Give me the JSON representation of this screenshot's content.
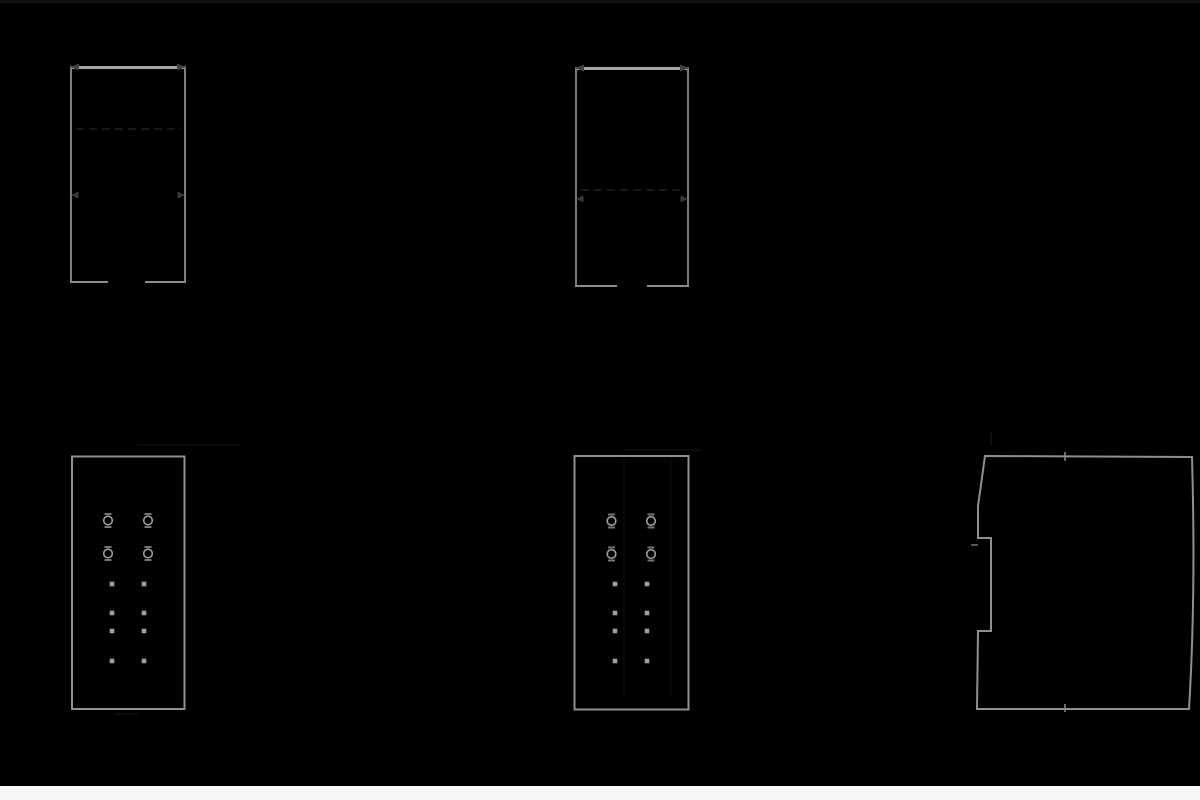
{
  "document": {
    "kind": "technical-dimension-drawing",
    "style": "inverted-dark",
    "background_color": "#000000",
    "page_strip_color": "#f8f8f8"
  },
  "colors": {
    "outline": "#8f8f8f",
    "outline_bright": "#a6a6a6",
    "outline_dim": "#787878",
    "terminal": "#9e9e9e",
    "bracket": "#757575",
    "led": "#9e9e9e",
    "arrow": "#3c3c3c",
    "faint": "#1c1c1c",
    "very_faint": "#111111"
  },
  "primitives": [
    {
      "name": "top-edge-band",
      "kind": "band",
      "x": 0,
      "y": 0,
      "width": 1200,
      "height": 3,
      "fill": "#121212"
    },
    {
      "name": "bottom-page-band",
      "kind": "band",
      "x": 0,
      "y": 786,
      "width": 1200,
      "height": 14,
      "fill": "#f8f8f8"
    },
    {
      "name": "front-view-1-top-edge",
      "kind": "line",
      "x1": 70,
      "y1": 67.5,
      "x2": 186,
      "y2": 67.5,
      "stroke": "#a6a6a6",
      "w": 3
    },
    {
      "name": "front-view-1-left-edge",
      "kind": "line",
      "x1": 71,
      "y1": 66,
      "x2": 71,
      "y2": 283,
      "stroke": "#7d7d7d",
      "w": 2
    },
    {
      "name": "front-view-1-right-edge",
      "kind": "line",
      "x1": 185,
      "y1": 66,
      "x2": 185,
      "y2": 283,
      "stroke": "#7d7d7d",
      "w": 2
    },
    {
      "name": "front-view-1-bottom-left-seg",
      "kind": "line",
      "x1": 70,
      "y1": 282,
      "x2": 108,
      "y2": 282,
      "stroke": "#8c8c8c",
      "w": 2
    },
    {
      "name": "front-view-1-bottom-right-seg",
      "kind": "line",
      "x1": 145,
      "y1": 282,
      "x2": 186,
      "y2": 282,
      "stroke": "#8c8c8c",
      "w": 2
    },
    {
      "name": "front-view-1-hidden-line",
      "kind": "line",
      "x1": 76,
      "y1": 129,
      "x2": 181,
      "y2": 129,
      "stroke": "#1f1f1f",
      "w": 1.5,
      "dash": "8 5"
    },
    {
      "name": "dim-arrow-icon",
      "kind": "path",
      "d": "M70,67 L79,63.5 L79,70.5 Z",
      "fill": "#404040"
    },
    {
      "name": "dim-arrow-icon",
      "kind": "path",
      "d": "M186,67 L177,63.5 L177,70.5 Z",
      "fill": "#404040"
    },
    {
      "name": "dim-arrow-icon",
      "kind": "path",
      "d": "M71,195 L78.5,191.5 L78.5,198.5 Z",
      "fill": "#383838"
    },
    {
      "name": "dim-arrow-icon",
      "kind": "path",
      "d": "M185,195 L177.5,191.5 L177.5,198.5 Z",
      "fill": "#383838"
    },
    {
      "name": "front-view-2-top-edge",
      "kind": "line",
      "x1": 575,
      "y1": 68.5,
      "x2": 689,
      "y2": 68.5,
      "stroke": "#a6a6a6",
      "w": 3
    },
    {
      "name": "front-view-2-left-edge",
      "kind": "line",
      "x1": 576,
      "y1": 67,
      "x2": 576,
      "y2": 287,
      "stroke": "#787878",
      "w": 2
    },
    {
      "name": "front-view-2-right-edge",
      "kind": "line",
      "x1": 688,
      "y1": 67,
      "x2": 688,
      "y2": 287,
      "stroke": "#787878",
      "w": 2
    },
    {
      "name": "front-view-2-bottom-left-seg",
      "kind": "line",
      "x1": 575,
      "y1": 286,
      "x2": 617,
      "y2": 286,
      "stroke": "#8c8c8c",
      "w": 2
    },
    {
      "name": "front-view-2-bottom-right-seg",
      "kind": "line",
      "x1": 647,
      "y1": 286,
      "x2": 689,
      "y2": 286,
      "stroke": "#8c8c8c",
      "w": 2
    },
    {
      "name": "front-view-2-hidden-line",
      "kind": "line",
      "x1": 581,
      "y1": 190,
      "x2": 683,
      "y2": 190,
      "stroke": "#202020",
      "w": 1.5,
      "dash": "8 5"
    },
    {
      "name": "dim-arrow-icon",
      "kind": "path",
      "d": "M575,68 L584,64.5 L584,71.5 Z",
      "fill": "#404040"
    },
    {
      "name": "dim-arrow-icon",
      "kind": "path",
      "d": "M689,68 L680,64.5 L680,71.5 Z",
      "fill": "#404040"
    },
    {
      "name": "dim-arrow-icon",
      "kind": "path",
      "d": "M576,199 L583.5,195.5 L583.5,202.5 Z",
      "fill": "#383838"
    },
    {
      "name": "dim-arrow-icon",
      "kind": "path",
      "d": "M688,199 L680.5,195.5 L680.5,202.5 Z",
      "fill": "#383838"
    },
    {
      "name": "terminal-view-1-outline",
      "kind": "rect",
      "x": 72,
      "y": 456.5,
      "width": 112.5,
      "height": 252.5,
      "stroke": "#909090",
      "w": 2
    },
    {
      "name": "terminal-view-1-dim-line-above",
      "kind": "line",
      "x1": 137,
      "y1": 445,
      "x2": 240,
      "y2": 445,
      "stroke": "#181818",
      "w": 1
    },
    {
      "name": "terminal-view-1-dim-line-below",
      "kind": "line",
      "x1": 116,
      "y1": 714,
      "x2": 138,
      "y2": 714,
      "stroke": "#181818",
      "w": 1
    },
    {
      "name": "screw-terminal-icon",
      "kind": "terminal",
      "cx": 108,
      "cy": 520.5
    },
    {
      "name": "screw-terminal-icon",
      "kind": "terminal",
      "cx": 148,
      "cy": 520.5
    },
    {
      "name": "screw-terminal-icon",
      "kind": "terminal",
      "cx": 108,
      "cy": 553.5
    },
    {
      "name": "screw-terminal-icon",
      "kind": "terminal",
      "cx": 148,
      "cy": 553.5
    },
    {
      "name": "led-indicator-icon",
      "kind": "sq",
      "cx": 112,
      "cy": 584,
      "s": 4.6
    },
    {
      "name": "led-indicator-icon",
      "kind": "sq",
      "cx": 144,
      "cy": 584,
      "s": 4.6
    },
    {
      "name": "led-indicator-icon",
      "kind": "sq",
      "cx": 112,
      "cy": 613,
      "s": 4.6
    },
    {
      "name": "led-indicator-icon",
      "kind": "sq",
      "cx": 144,
      "cy": 613,
      "s": 4.6
    },
    {
      "name": "led-indicator-icon",
      "kind": "sq",
      "cx": 112,
      "cy": 631,
      "s": 4.6
    },
    {
      "name": "led-indicator-icon",
      "kind": "sq",
      "cx": 144,
      "cy": 631,
      "s": 4.6
    },
    {
      "name": "led-indicator-icon",
      "kind": "sq",
      "cx": 112,
      "cy": 661,
      "s": 4.6
    },
    {
      "name": "led-indicator-icon",
      "kind": "sq",
      "cx": 144,
      "cy": 661,
      "s": 4.6
    },
    {
      "name": "terminal-view-2-outline",
      "kind": "rect",
      "x": 574.5,
      "y": 456,
      "width": 114,
      "height": 253.5,
      "stroke": "#909090",
      "w": 2
    },
    {
      "name": "terminal-view-2-seam-left",
      "kind": "line",
      "x1": 624,
      "y1": 458,
      "x2": 624,
      "y2": 698,
      "stroke": "#111111",
      "w": 1
    },
    {
      "name": "terminal-view-2-seam-right",
      "kind": "line",
      "x1": 671,
      "y1": 458,
      "x2": 671,
      "y2": 698,
      "stroke": "#111111",
      "w": 1
    },
    {
      "name": "terminal-view-2-dim-line-above",
      "kind": "line",
      "x1": 623,
      "y1": 450,
      "x2": 700,
      "y2": 450,
      "stroke": "#161616",
      "w": 1
    },
    {
      "name": "screw-terminal-icon",
      "kind": "terminal",
      "cx": 611.5,
      "cy": 521
    },
    {
      "name": "screw-terminal-icon",
      "kind": "terminal",
      "cx": 651,
      "cy": 521
    },
    {
      "name": "screw-terminal-icon",
      "kind": "terminal",
      "cx": 611.5,
      "cy": 554
    },
    {
      "name": "screw-terminal-icon",
      "kind": "terminal",
      "cx": 651,
      "cy": 554
    },
    {
      "name": "led-indicator-icon",
      "kind": "sq",
      "cx": 615,
      "cy": 584,
      "s": 4.6
    },
    {
      "name": "led-indicator-icon",
      "kind": "sq",
      "cx": 647,
      "cy": 584,
      "s": 4.6
    },
    {
      "name": "led-indicator-icon",
      "kind": "sq",
      "cx": 615,
      "cy": 613,
      "s": 4.6
    },
    {
      "name": "led-indicator-icon",
      "kind": "sq",
      "cx": 647,
      "cy": 613,
      "s": 4.6
    },
    {
      "name": "led-indicator-icon",
      "kind": "sq",
      "cx": 615,
      "cy": 631,
      "s": 4.6
    },
    {
      "name": "led-indicator-icon",
      "kind": "sq",
      "cx": 647,
      "cy": 631,
      "s": 4.6
    },
    {
      "name": "led-indicator-icon",
      "kind": "sq",
      "cx": 615,
      "cy": 661,
      "s": 4.6
    },
    {
      "name": "led-indicator-icon",
      "kind": "sq",
      "cx": 647,
      "cy": 661,
      "s": 4.6
    },
    {
      "name": "side-profile-outline",
      "kind": "path",
      "d": "M985,456 L1192,457 Q1196,595 1189,709 L977,709 L978,631 L991,631 L991,538 L978,538 L978,506 Z",
      "stroke": "#8f8f8f",
      "w": 2
    },
    {
      "name": "side-profile-center-tick-top",
      "kind": "line",
      "x1": 1065,
      "y1": 452,
      "x2": 1065,
      "y2": 461,
      "stroke": "#8f8f8f",
      "w": 1.5
    },
    {
      "name": "side-profile-center-tick-bottom",
      "kind": "line",
      "x1": 1065,
      "y1": 704,
      "x2": 1065,
      "y2": 712,
      "stroke": "#8f8f8f",
      "w": 1.5
    },
    {
      "name": "din-clip-tick",
      "kind": "line",
      "x1": 971,
      "y1": 545,
      "x2": 978,
      "y2": 545,
      "stroke": "#757575",
      "w": 1.5
    },
    {
      "name": "side-profile-extension-line",
      "kind": "line",
      "x1": 991,
      "y1": 431,
      "x2": 991,
      "y2": 446,
      "stroke": "#1c1c1c",
      "w": 1
    }
  ],
  "terminal_style": {
    "radius": 4.3,
    "ring_stroke": "#9e9e9e",
    "ring_width": 1.6,
    "bracket_stroke": "#757575",
    "bracket_width": 2,
    "bracket_half_width": 3.5,
    "bracket_offset_y": 6.5
  }
}
